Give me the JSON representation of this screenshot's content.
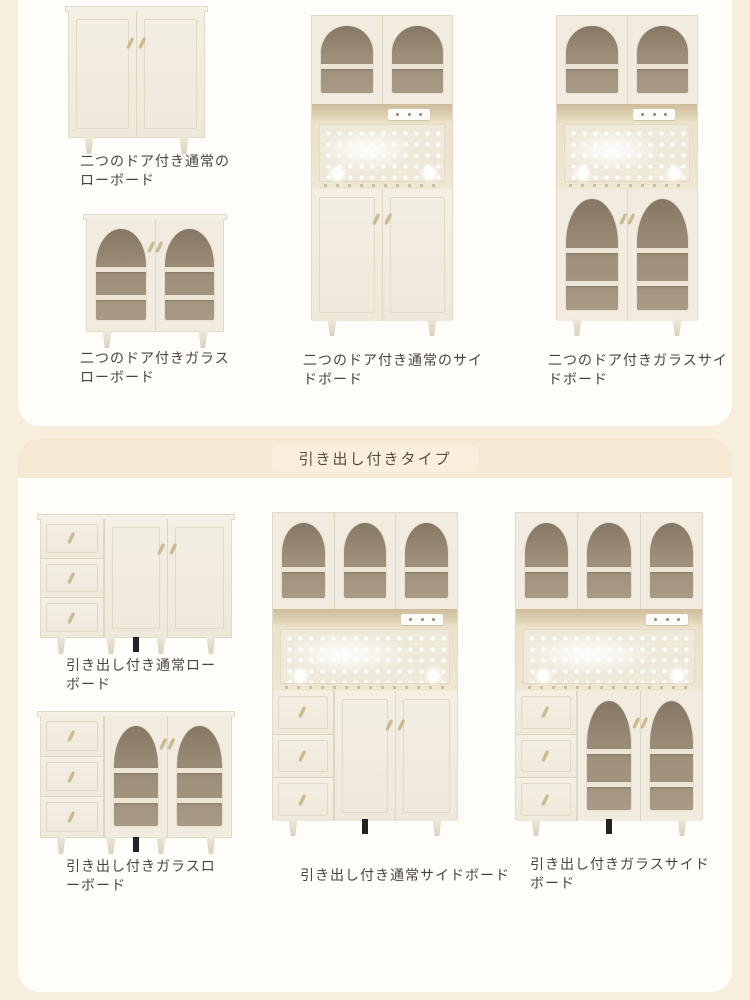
{
  "page": {
    "background_color": "#f8eedd",
    "panel_color": "#fffdf9",
    "band_color": "#f6e9d2",
    "label_text_color": "#4b463d",
    "cabinet_body_color": "#f1ecdf",
    "glass_interior_color": "#a2947d",
    "handle_color": "#cdba8c"
  },
  "sections": {
    "door_types": {
      "items": [
        {
          "label": "二つのドア付き通常のローボード"
        },
        {
          "label": "二つのドア付きガラスローボード"
        },
        {
          "label": "二つのドア付き通常のサイドボード"
        },
        {
          "label": "二つのドア付きガラスサイドボード"
        }
      ]
    },
    "drawer_types": {
      "title": "引き出し付きタイプ",
      "items": [
        {
          "label": "引き出し付き通常ローボード"
        },
        {
          "label": "引き出し付きガラスローボード"
        },
        {
          "label": "引き出し付き通常サイドボード"
        },
        {
          "label": "引き出し付きガラスサイドボード"
        }
      ]
    }
  }
}
